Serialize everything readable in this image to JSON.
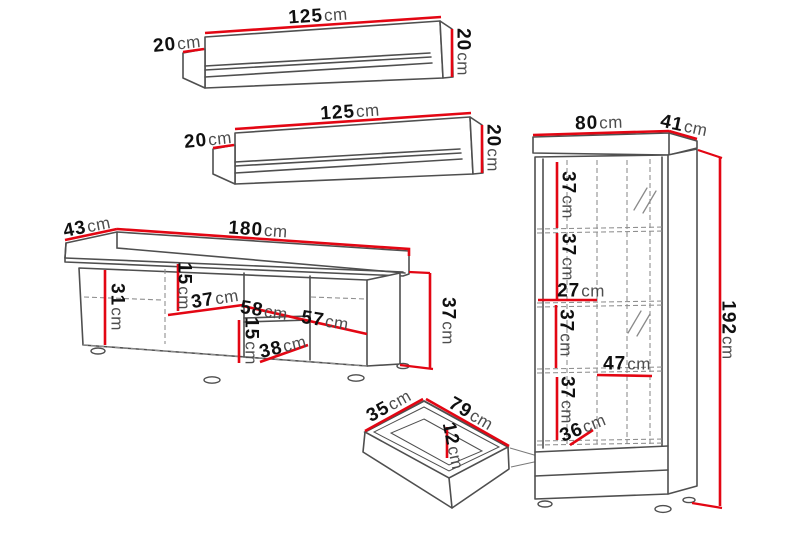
{
  "unit": "cm",
  "colors": {
    "dimension_line": "#e30613",
    "outline": "#4f4f4f",
    "hidden_line": "#8f8f8f",
    "number_text": "#101010",
    "unit_text": "#4d4d4d",
    "background": "#ffffff"
  },
  "shelf1": {
    "width": "125",
    "depth": "20",
    "height": "20"
  },
  "shelf2": {
    "width": "125",
    "depth": "20",
    "height": "20"
  },
  "tv": {
    "top_depth": "43",
    "width": "180",
    "left_height": "31",
    "niche_top_height": "15",
    "niche_depth": "37",
    "niche_width": "58",
    "right_width": "57",
    "niche_bottom_height": "15",
    "bottom_width": "38",
    "height": "37"
  },
  "drawer": {
    "depth": "35",
    "width": "79",
    "height": "12"
  },
  "cabinet": {
    "width": "80",
    "depth": "41",
    "section1_height": "37",
    "section2_height": "37",
    "left_shelf_width": "27",
    "section3_height": "37",
    "glass_shelf_width": "47",
    "section4_height": "37",
    "bottom_section_height": "36",
    "height": "192"
  }
}
